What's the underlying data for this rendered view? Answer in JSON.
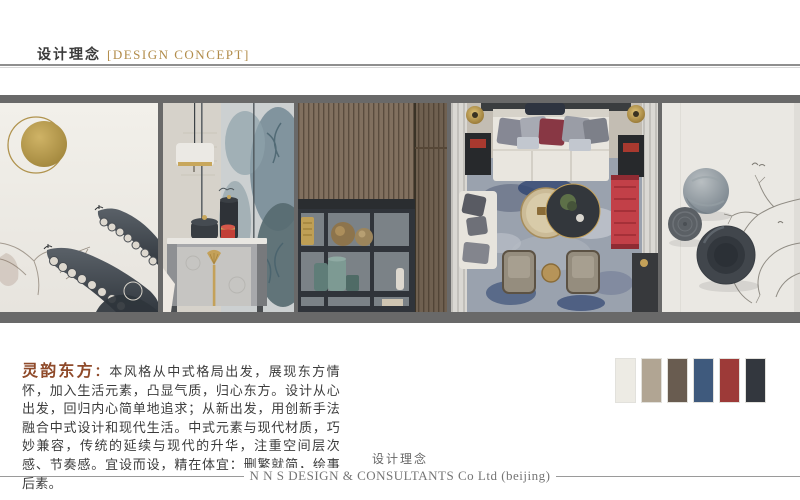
{
  "header": {
    "title_cn": "设计理念",
    "title_en": "[DESIGN CONCEPT]",
    "accent_color": "#b28c4a"
  },
  "gallery": {
    "band_color": "#696969",
    "photos": [
      {
        "name": "moon-and-eaves-ink-art",
        "description": "ink-wash painting of upturned Chinese roof eaves with a brass moon disc"
      },
      {
        "name": "chinoiserie-cabinet-vignette",
        "description": "gray nightstand with gold fan handle, black canisters and red tea jar against blue-gray botanical wallpaper, drum pendant lamp"
      },
      {
        "name": "wood-slat-shelf-display",
        "description": "vertical wood slat wall above dark open shelving with bronze spheres and teal ceramic jars"
      },
      {
        "name": "living-room-top-view",
        "description": "top-down view of a new-Chinese-style living room: cream sofa with gray and maroon pillows, blue patterned rug, round coffee tables, red chaise, two armchairs"
      },
      {
        "name": "round-disc-wall-art",
        "description": "three dark round ceramic wall discs beside a fine ink branch drawing with birds"
      }
    ]
  },
  "concept": {
    "lead": "灵韵东方",
    "separator": "：",
    "lead_color": "#8f4a2a",
    "body": "本风格从中式格局出发，展现东方情怀，加入生活元素，凸显气质，归心东方。设计从心出发，回归内心简单地追求；从新出发，用创新手法融合中式设计和现代生活。中式元素与现代材质，巧妙兼容，传统的延续与现代的升华，注重空间层次感、节奏感。宜设而设，精在体宜：删繁就简，绘事后素。"
  },
  "palette": {
    "swatches": [
      {
        "name": "off-white",
        "hex": "#edebe4"
      },
      {
        "name": "warm-taupe",
        "hex": "#b1a593"
      },
      {
        "name": "dark-brown",
        "hex": "#695c50"
      },
      {
        "name": "steel-blue",
        "hex": "#3f5a7d"
      },
      {
        "name": "brick-red",
        "hex": "#9d3a38"
      },
      {
        "name": "charcoal",
        "hex": "#33373e"
      }
    ]
  },
  "footer": {
    "title_cn": "设计理念",
    "company": "N N S DESIGN & CONSULTANTS Co Ltd (beijing)"
  }
}
